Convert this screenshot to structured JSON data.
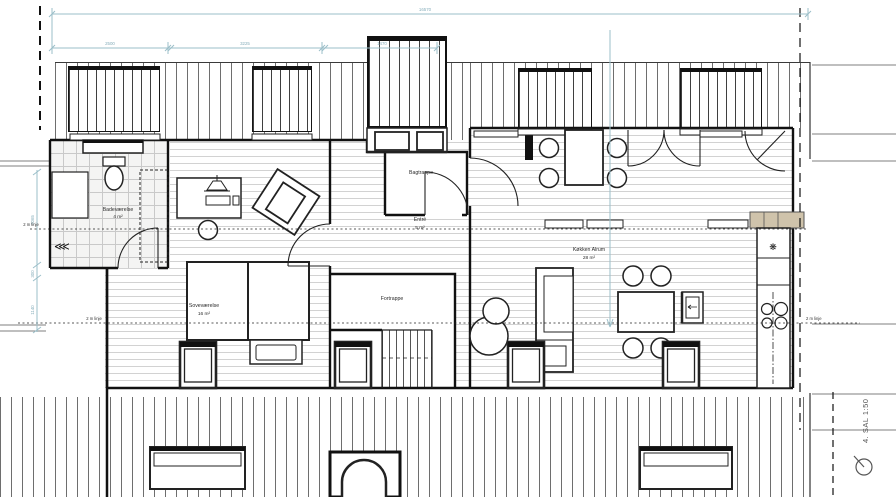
{
  "title_block": {
    "label": "4. SAL 1:50"
  },
  "rooms": {
    "bathroom": {
      "name": "Badeværelse",
      "area": "4 m²"
    },
    "bedroom": {
      "name": "Soveværelse",
      "area": "16 m²"
    },
    "entry": {
      "name": "Entré",
      "area": "5 m²"
    },
    "kitchen": {
      "name": "Køkken Alrum",
      "area": "28 m²"
    },
    "front_stairs": {
      "name": "Fortrappe"
    },
    "back_stairs": {
      "name": "Bagtrappe"
    }
  },
  "dimensions": {
    "overall_width": "16570",
    "seg_1": "2500",
    "seg_2": "3225",
    "seg_3": "1470",
    "left_1": "2065",
    "left_2": "300",
    "left_3": "1140"
  },
  "annotations": {
    "two_meter_line": "2 m linje"
  },
  "symbols": {
    "freezer": "❋",
    "shower": "⋘"
  }
}
